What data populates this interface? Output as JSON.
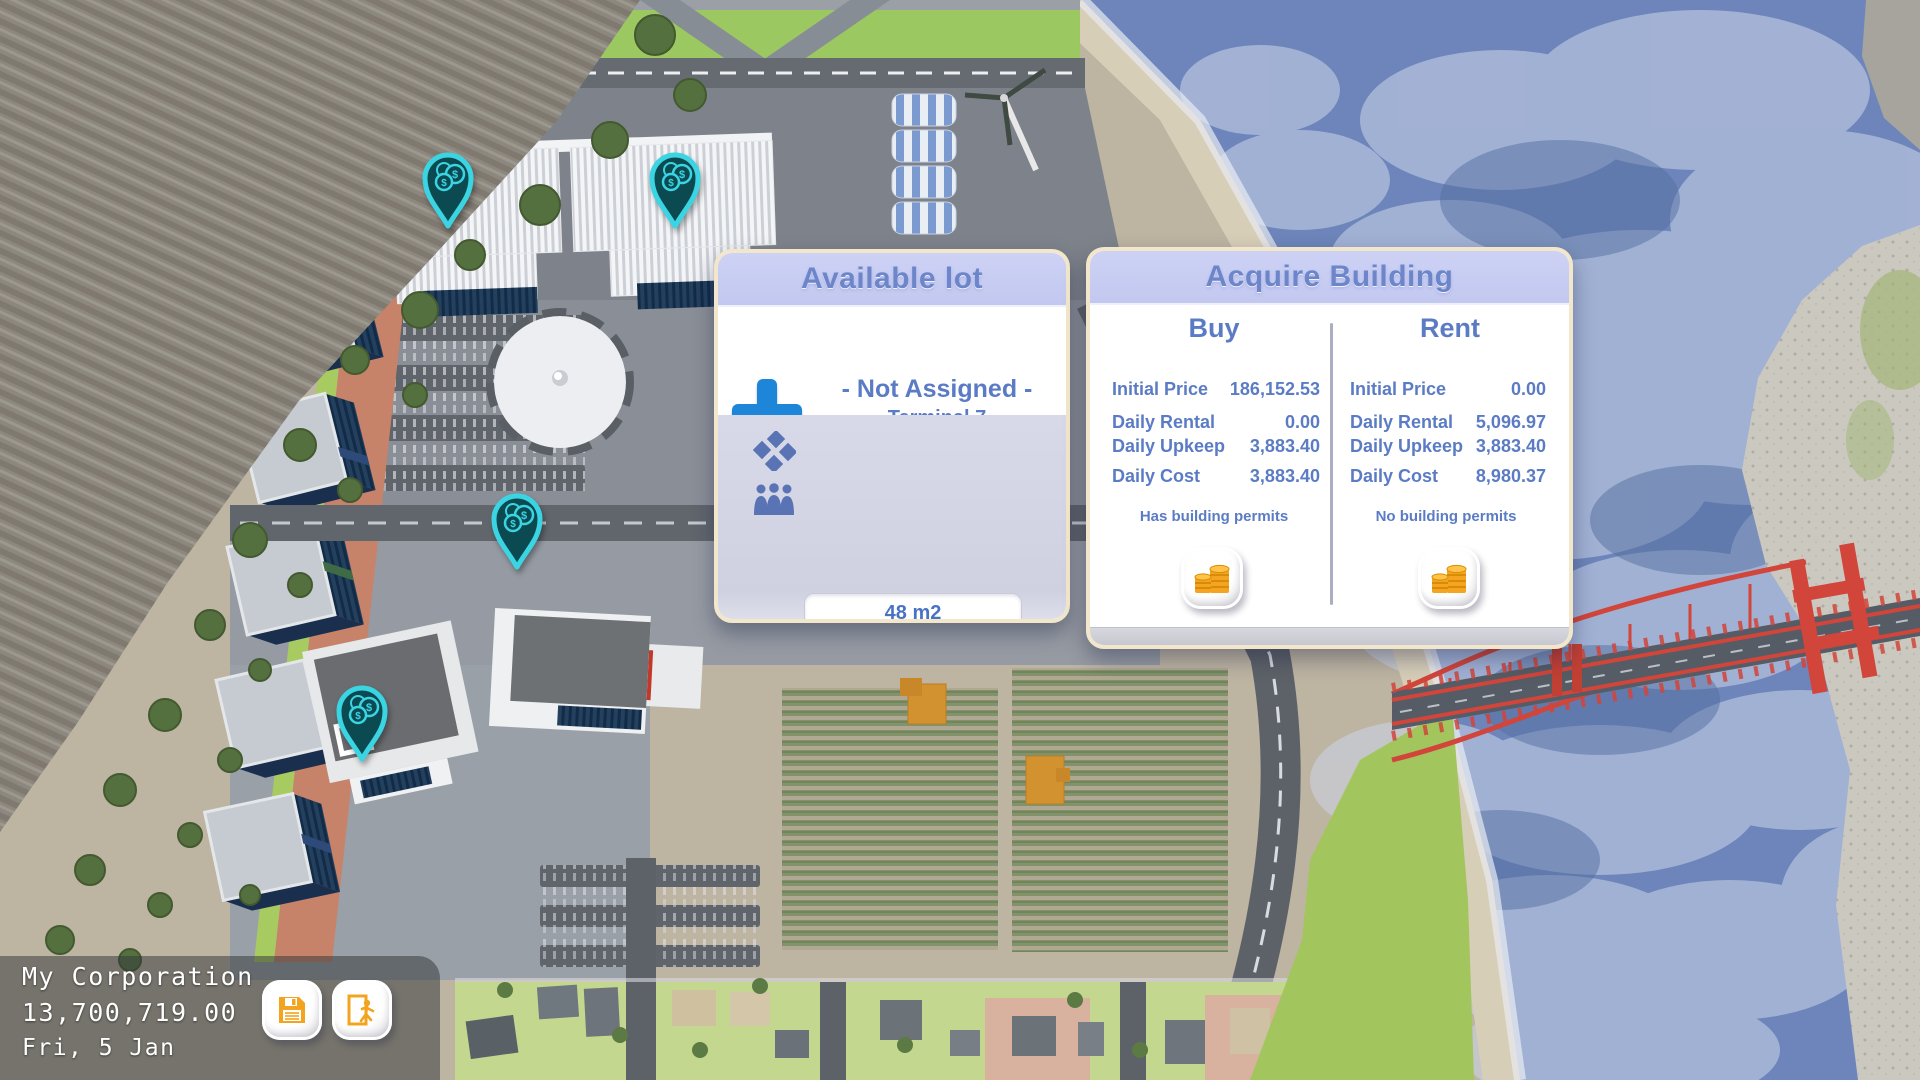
{
  "hud": {
    "corporation_name": "My Corporation",
    "balance": "13,700,719.00",
    "date": "Fri, 5 Jan",
    "save_icon": "save-floppy",
    "exit_icon": "exit-door"
  },
  "available_lot": {
    "title": "Available lot",
    "assignment_status": "- Not Assigned -",
    "lot_label": "Terminal 7",
    "size_value": "48 m2",
    "population_value": "High",
    "info_glyph": "i",
    "icons": {
      "add": "plus",
      "size": "area-diamond",
      "population": "people-group",
      "info": "info-italic-i",
      "assign": "city-buildings",
      "close": "orange-x"
    }
  },
  "acquire_building": {
    "title": "Acquire Building",
    "buy": {
      "header": "Buy",
      "rows": [
        {
          "label": "Initial Price",
          "value": "186,152.53"
        },
        {
          "label": "Daily Rental",
          "value": "0.00"
        },
        {
          "label": "Daily Upkeep",
          "value": "3,883.40"
        },
        {
          "label": "Daily Cost",
          "value": "3,883.40"
        }
      ],
      "permits_note": "Has building permits",
      "action_icon": "coin-stacks"
    },
    "rent": {
      "header": "Rent",
      "rows": [
        {
          "label": "Initial Price",
          "value": "0.00"
        },
        {
          "label": "Daily Rental",
          "value": "5,096.97"
        },
        {
          "label": "Daily Upkeep",
          "value": "3,883.40"
        },
        {
          "label": "Daily Cost",
          "value": "8,980.37"
        }
      ],
      "permits_note": "No building permits",
      "action_icon": "coin-stacks"
    }
  },
  "map": {
    "pins": [
      "money-pin",
      "money-pin",
      "money-pin",
      "money-pin"
    ],
    "currency_symbol": "$"
  },
  "colors": {
    "accent_blue": "#4a72c4",
    "panel_header": "#c7ccf1",
    "panel_border": "#f3e7cb",
    "action_orange": "#f2a41e",
    "pin_teal": "#3bd4e2"
  }
}
